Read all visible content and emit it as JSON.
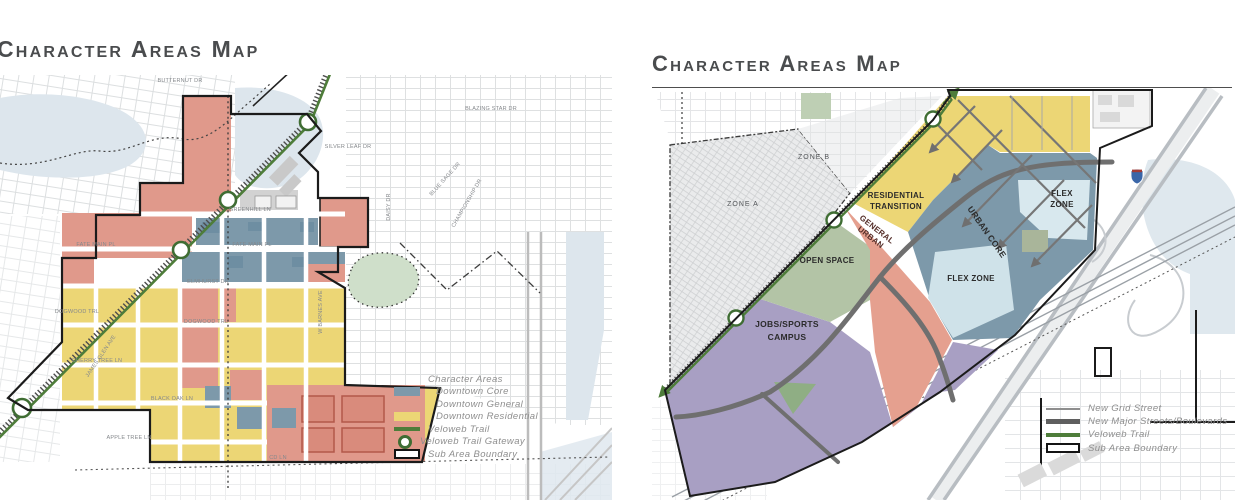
{
  "page": {
    "background": "#ffffff"
  },
  "left_map": {
    "title": "Character Areas Map",
    "legend": {
      "header": "Character Areas",
      "items": [
        {
          "label": "Downtown Core",
          "color": "#7d99aa"
        },
        {
          "label": "Downtown General",
          "color": "#e0998b"
        },
        {
          "label": "Downtown Residential",
          "color": "#ecd675"
        }
      ],
      "trail_label": "Veloweb Trail",
      "gateway_label": "Veloweb Trail Gateway",
      "boundary_label": "Sub Area Boundary"
    },
    "streets": {
      "butternut": "BUTTERNUT DR",
      "greenhill": "GREENHILL LN",
      "fate_main_w": "FATE MAIN PL",
      "fate_main_e": "FATE MAIN PL",
      "elmhurst": "ELMHURST DR",
      "dogwood_w": "DOGWOOD TRL",
      "dogwood_e": "DOGWOOD TRL",
      "cherry_tree": "CHERRY TREE LN",
      "black_oak": "BLACK OAK LN",
      "apple_tree": "APPLE TREE LN",
      "cd_ln": "CD LN",
      "blazing_star": "BLAZING STAR DR",
      "silver_leaf": "SILVER LEAF DR",
      "daisy": "DAISY DR",
      "blue_sage": "BLUE SAGE DR",
      "championship": "CHAMPIONSHIP DR",
      "james_glen": "JAMES GLEN AVE",
      "barnes": "W BARNES AVE"
    }
  },
  "right_map": {
    "title": "Character Areas Map",
    "zone_labels": {
      "residential_transition": [
        "RESIDENTIAL",
        "TRANSITION"
      ],
      "general_urban": [
        "GENERAL",
        "URBAN"
      ],
      "urban_core": "URBAN CORE",
      "flex_zone_right": [
        "FLEX",
        "ZONE"
      ],
      "flex_zone_center": "FLEX ZONE",
      "open_space": "OPEN SPACE",
      "jobs_sports_campus": [
        "JOBS/SPORTS",
        "CAMPUS"
      ],
      "zone_a": "ZONE A",
      "zone_b": "ZONE B"
    },
    "legend": {
      "items": [
        {
          "label": "New Grid Street"
        },
        {
          "label": "New Major Streets/Boulevards"
        },
        {
          "label": "Veloweb Trail"
        },
        {
          "label": "Sub Area Boundary"
        }
      ]
    }
  },
  "colors": {
    "downtown_core": "#7d99aa",
    "downtown_general": "#e0998b",
    "downtown_residential": "#ecd675",
    "urban_core": "#7d99aa",
    "general_urban": "#e5a08f",
    "residential_transition": "#ecd675",
    "flex_zone": "#cfe2e9",
    "open_space": "#b3c4a6",
    "jobs_sports_campus": "#a89fc3",
    "veloweb_trail": "#4e7d3a",
    "boundary": "#1b1b1b",
    "road_dark": "#6f6f6f",
    "water": "#dde6ed",
    "title_text": "#4a4c4e",
    "legend_text": "#8e8e8e"
  }
}
